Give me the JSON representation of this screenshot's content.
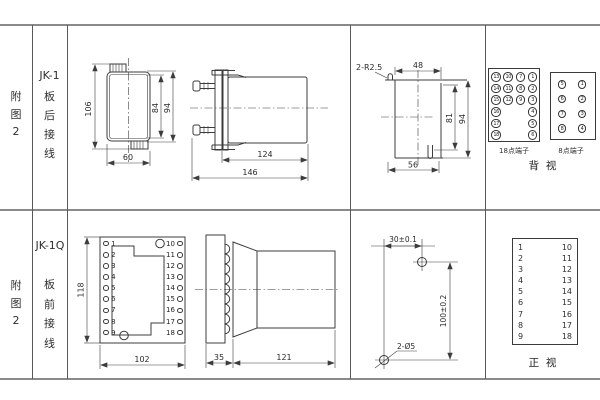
{
  "row1": {
    "figure_label": "附\n图\n2",
    "model_label": "JK-1",
    "wiring_label": "板\n后\n接\n线",
    "front_view": {
      "dim_overall_height": "106",
      "dim_case_height": "84",
      "dim_flange_height": "94",
      "dim_width": "60"
    },
    "side_view": {
      "dim_body_length": "124",
      "dim_total_length": "146"
    },
    "cutout_view": {
      "dim_slot": "2-R2.5",
      "dim_top_width": "48",
      "dim_inner_height": "81",
      "dim_outer_height": "94",
      "dim_bottom_width": "56"
    },
    "rear_panel": {
      "t18_label": "18点端子",
      "t18_grid": [
        [
          "13",
          "10",
          "7",
          "1"
        ],
        [
          "14",
          "11",
          "8",
          "2"
        ],
        [
          "15",
          "12",
          "9",
          "3"
        ],
        [
          "16",
          null,
          null,
          "4"
        ],
        [
          "17",
          null,
          null,
          "5"
        ],
        [
          "18",
          null,
          null,
          "6"
        ]
      ],
      "t8_label": "8点端子",
      "t8_grid": [
        [
          "5",
          "1"
        ],
        [
          "6",
          "2"
        ],
        [
          "7",
          "3"
        ],
        [
          "8",
          "4"
        ]
      ],
      "view_label": "背  视"
    }
  },
  "row2": {
    "figure_label": "附\n图\n2",
    "model_label": "JK-1Q",
    "wiring_label": "板\n前\n接\n线",
    "socket_view": {
      "left_pins": [
        "1",
        "2",
        "3",
        "4",
        "5",
        "6",
        "7",
        "8",
        "9"
      ],
      "right_pins": [
        "10",
        "11",
        "12",
        "13",
        "14",
        "15",
        "16",
        "17",
        "18"
      ],
      "dim_height": "118",
      "dim_width": "102"
    },
    "side_view": {
      "dim_flange": "35",
      "dim_body": "121"
    },
    "drill_view": {
      "dim_horizontal": "30±0.1",
      "dim_vertical": "100±0.2",
      "dim_holes": "2-Ø5"
    },
    "front_panel": {
      "left_pins": [
        "1",
        "2",
        "3",
        "4",
        "5",
        "6",
        "7",
        "8",
        "9"
      ],
      "right_pins": [
        "10",
        "11",
        "12",
        "13",
        "14",
        "15",
        "16",
        "17",
        "18"
      ],
      "view_label": "正  视"
    }
  }
}
